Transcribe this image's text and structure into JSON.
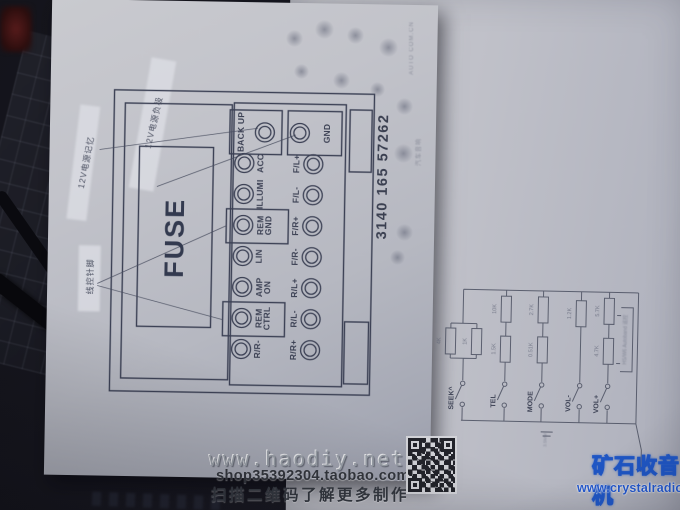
{
  "diagram_paper": {
    "fuse_label": "FUSE",
    "part_number": "3140 165 57262",
    "connector": {
      "column_a": [
        {
          "label": "BACK UP"
        },
        {
          "label": "ACC"
        },
        {
          "label": "ILLUMI"
        },
        {
          "label": "REM GND"
        },
        {
          "label": "LIN"
        },
        {
          "label": "AMP ON"
        },
        {
          "label": "REM CTRL"
        },
        {
          "label": "R/R-"
        }
      ],
      "column_b": [
        {
          "label": "GND"
        },
        {
          "label": "F/L+"
        },
        {
          "label": "F/L-"
        },
        {
          "label": "F/R+"
        },
        {
          "label": "F/R-"
        },
        {
          "label": "R/L+"
        },
        {
          "label": "R/L-"
        },
        {
          "label": "R/R+"
        }
      ]
    },
    "callouts": {
      "power_memory": "12V电源记忆",
      "power_negative": "12V电源负极",
      "wire_control": "线控针脚",
      "edge_text_1": "汽车音响",
      "edge_text_2": "AUTO COM.CN"
    }
  },
  "schematic_paper": {
    "buttons": [
      "SEEK^",
      "TEL",
      "MODE",
      "VOL-",
      "VOL+"
    ],
    "resistor_values": [
      "4K",
      "1K",
      "10K",
      "1.5K",
      "2.7K",
      "0.51K",
      "1.2K",
      "5.7K",
      "4.7K"
    ],
    "plug_note": "3.5MM",
    "side_note": "HS/W6 Autoband 遥控"
  },
  "watermarks": {
    "haodiy_url": "www.haodiy.net",
    "taobao_shop": "shop35392304.taobao.com",
    "qr_caption": "扫描二维码了解更多制作",
    "crystalradio_name": "矿石收音机",
    "crystalradio_url": "www.crystalradio.cn"
  }
}
